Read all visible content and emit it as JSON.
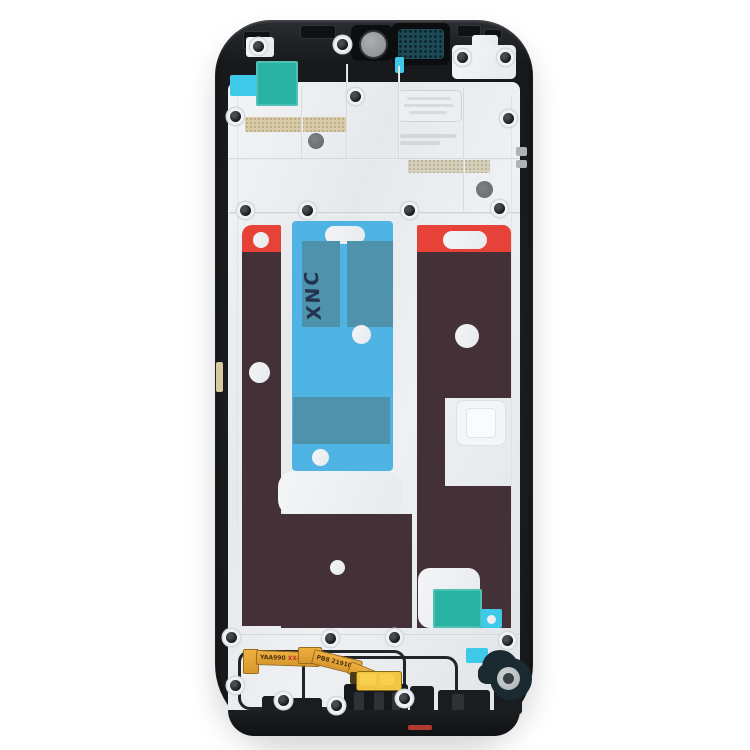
{
  "subject": "Front housing LCD frame bezel plate for smartphone (spare part product photo)",
  "markings": {
    "tape_handwriting": "XNC",
    "flex_label_left": "YAA990",
    "flex_label_left_suffix": "XX-G",
    "flex_label_right": "PB8 219102"
  },
  "colors": {
    "frame-black": "#1b1e21",
    "plate-silver": "#e9ecef",
    "adhesive-brown": "#443137",
    "adhesive-red": "#e64238",
    "tape-cyan": "#4fb4e4",
    "tape-teal": "#4e92ac",
    "sticker-teal": "#29b2a4",
    "sticker-cyan": "#3fc9e9",
    "flex-gold": "#e8a838",
    "mesh-teal": "#1d4a56",
    "background": "#ffffff"
  }
}
